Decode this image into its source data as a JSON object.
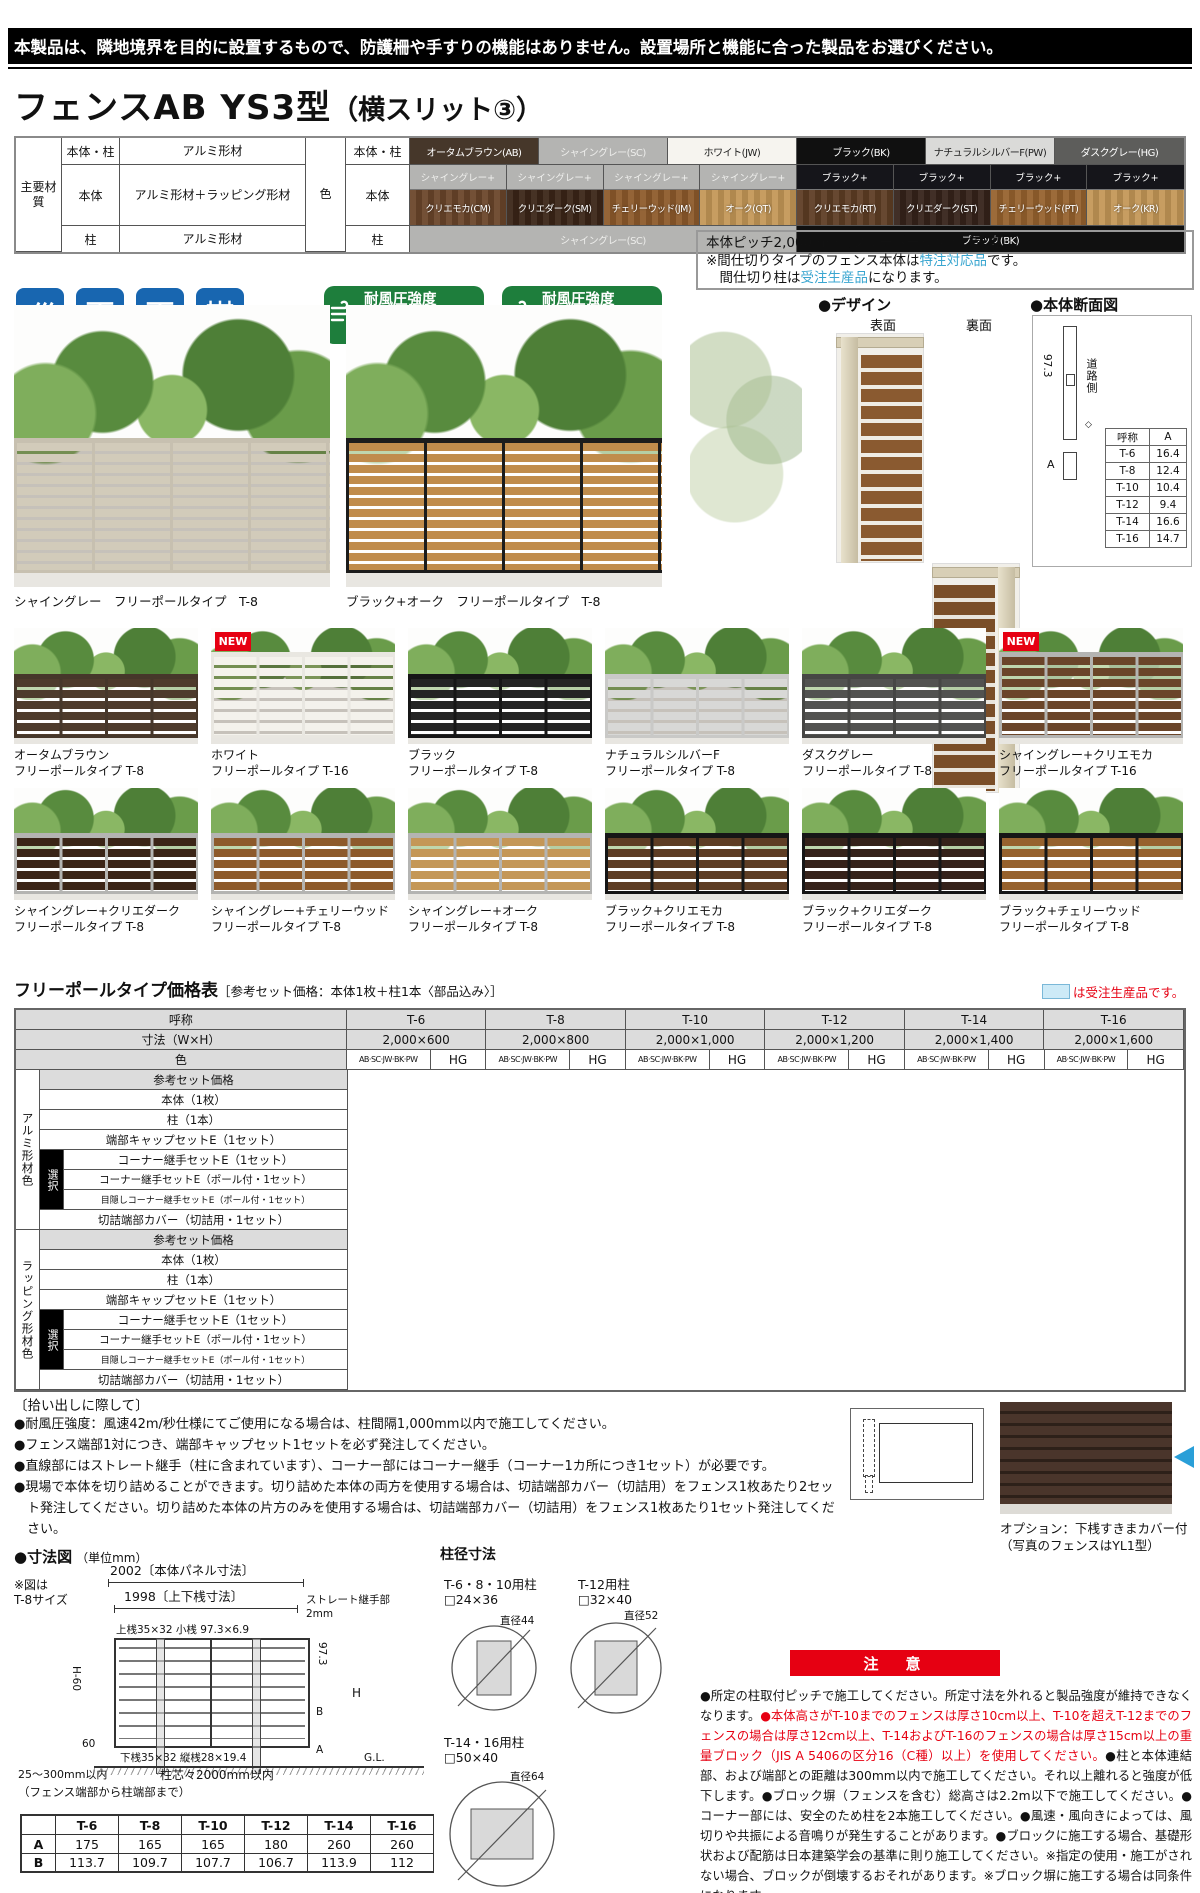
{
  "header": {
    "notice": "本製品は、隣地境界を目的に設置するもので、防護柵や手すりの機能はありません。設置場所と機能に合った製品をお選びください。",
    "title_main": "フェンスAB YS3型",
    "title_sub": "（横スリット③）"
  },
  "spec": {
    "material_group_label": "主要材質",
    "material_rows": [
      {
        "label": "本体・柱",
        "value": "アルミ形材"
      },
      {
        "label": "本体",
        "value": "アルミ形材＋ラッピング形材"
      },
      {
        "label": "柱",
        "value": "アルミ形材"
      }
    ],
    "color_group_label": "色",
    "color_row_labels": [
      "本体・柱",
      "本体",
      "柱"
    ],
    "single_colors": [
      {
        "label": "オータムブラウン(AB)",
        "bg": "#46372a",
        "fg": "#ffffff"
      },
      {
        "label": "シャイングレー(SC)",
        "bg": "#b4b4b2",
        "fg": "#ededeb"
      },
      {
        "label": "ホワイト(JW)",
        "bg": "#f6f4ef",
        "fg": "#222222"
      },
      {
        "label": "ブラック(BK)",
        "bg": "#101010",
        "fg": "#ffffff"
      },
      {
        "label": "ナチュラルシルバーF(PW)",
        "bg": "#dadad8",
        "fg": "#222222"
      },
      {
        "label": "ダスクグレー(HG)",
        "bg": "#5d5d5b",
        "fg": "#ffffff"
      }
    ],
    "combo_colors": [
      {
        "top": "シャイングレー+",
        "top_bg": "#b4b4b2",
        "top_fg": "#f0f0ee",
        "bottom": "クリエモカ(CM)",
        "bottom_bg": "#6a452a"
      },
      {
        "top": "シャイングレー+",
        "top_bg": "#b4b4b2",
        "top_fg": "#f0f0ee",
        "bottom": "クリエダーク(SM)",
        "bottom_bg": "#3b2517"
      },
      {
        "top": "シャイングレー+",
        "top_bg": "#b4b4b2",
        "top_fg": "#f0f0ee",
        "bottom": "チェリーウッド(JM)",
        "bottom_bg": "#8d5a2b"
      },
      {
        "top": "シャイングレー+",
        "top_bg": "#b4b4b2",
        "top_fg": "#f0f0ee",
        "bottom": "オーク(QT)",
        "bottom_bg": "#c49757"
      },
      {
        "top": "ブラック+",
        "top_bg": "#15151a",
        "top_fg": "#ffffff",
        "bottom": "クリエモカ(RT)",
        "bottom_bg": "#5e3d24"
      },
      {
        "top": "ブラック+",
        "top_bg": "#15151a",
        "top_fg": "#ffffff",
        "bottom": "クリエダーク(ST)",
        "bottom_bg": "#35221a"
      },
      {
        "top": "ブラック+",
        "top_bg": "#15151a",
        "top_fg": "#ffffff",
        "bottom": "チェリーウッド(PT)",
        "bottom_bg": "#96622e"
      },
      {
        "top": "ブラック+",
        "top_bg": "#15151a",
        "top_fg": "#ffffff",
        "bottom": "オーク(KR)",
        "bottom_bg": "#c49757"
      }
    ],
    "post_colors": [
      {
        "label": "シャイングレー(SC)",
        "bg": "#b4b4b2",
        "fg": "#ededeb"
      },
      {
        "label": "ブラック(BK)",
        "bg": "#101010",
        "fg": "#ffffff"
      }
    ]
  },
  "features": {
    "icons": [
      {
        "label": "片面模様"
      },
      {
        "label": "フリーポール（自在柱）"
      },
      {
        "label": "間仕切り※（間柱）"
      },
      {
        "label": "多段取付可能"
      }
    ],
    "wind_badges": [
      {
        "title": "耐風圧強度",
        "prefix": "風速",
        "value": "34",
        "unit": "m/秒",
        "suffix": "相当",
        "caption": "柱ピッチ2m以下"
      },
      {
        "title": "耐風圧強度",
        "prefix": "風速",
        "value": "42",
        "unit": "m/秒",
        "suffix": "相当",
        "caption": "柱ピッチ1m以下"
      }
    ],
    "info_box": {
      "line1": "本体ピッチ2,000mm（フリーポールタイプ専用）",
      "line2_pre": "※間仕切りタイプのフェンス本体は",
      "line2_em": "特注対応品",
      "line2_post": "です。",
      "line3_pre": "　間仕切り柱は",
      "line3_em": "受注生産品",
      "line3_post": "になります。"
    }
  },
  "design": {
    "heading": "●デザイン",
    "front_label": "表面",
    "back_label": "裏面"
  },
  "cross_section": {
    "heading": "●本体断面図",
    "dim": "97.3",
    "road_label": "道路側",
    "a_label": "A",
    "table": {
      "headers": [
        "呼称",
        "A"
      ],
      "rows": [
        [
          "T-6",
          "16.4"
        ],
        [
          "T-8",
          "12.4"
        ],
        [
          "T-10",
          "10.4"
        ],
        [
          "T-12",
          "9.4"
        ],
        [
          "T-14",
          "16.6"
        ],
        [
          "T-16",
          "14.7"
        ]
      ]
    }
  },
  "photos": {
    "new_badge": "NEW",
    "row1": [
      {
        "caption": "シャイングレー　フリーポールタイプ　T-8",
        "frame": "#c7c0b0",
        "slat": "#d2cbba",
        "tall": false,
        "new": false
      },
      {
        "caption": "ブラック+オーク　フリーポールタイプ　T-8",
        "frame": "#1c1c1c",
        "slat": "#c08c4c",
        "tall": false,
        "new": false
      }
    ],
    "row2": [
      {
        "name": "オータムブラウン",
        "type": "フリーポールタイプ T-8",
        "frame": "#46372a",
        "slat": "#4e3b2c",
        "new": false,
        "tall": false
      },
      {
        "name": "ホワイト",
        "type": "フリーポールタイプ T-16",
        "frame": "#e9e7e1",
        "slat": "#f4f2ec",
        "new": true,
        "tall": true
      },
      {
        "name": "ブラック",
        "type": "フリーポールタイプ T-8",
        "frame": "#161616",
        "slat": "#242424",
        "new": false,
        "tall": false
      },
      {
        "name": "ナチュラルシルバーF",
        "type": "フリーポールタイプ T-8",
        "frame": "#c9c9c7",
        "slat": "#d8d8d6",
        "new": false,
        "tall": false
      },
      {
        "name": "ダスクグレー",
        "type": "フリーポールタイプ T-8",
        "frame": "#464644",
        "slat": "#525250",
        "new": false,
        "tall": false
      },
      {
        "name": "シャイングレー+クリエモカ",
        "type": "フリーポールタイプ T-16",
        "frame": "#b4b4b2",
        "slat": "#6a452a",
        "new": true,
        "tall": true
      }
    ],
    "row3": [
      {
        "name": "シャイングレー+クリエダーク",
        "type": "フリーポールタイプ T-8",
        "frame": "#b4b4b2",
        "slat": "#3b2517",
        "new": false,
        "tall": false
      },
      {
        "name": "シャイングレー+チェリーウッド",
        "type": "フリーポールタイプ T-8",
        "frame": "#b4b4b2",
        "slat": "#8d5a2b",
        "new": false,
        "tall": false
      },
      {
        "name": "シャイングレー+オーク",
        "type": "フリーポールタイプ T-8",
        "frame": "#b4b4b2",
        "slat": "#c49757",
        "new": false,
        "tall": false
      },
      {
        "name": "ブラック+クリエモカ",
        "type": "フリーポールタイプ T-8",
        "frame": "#161616",
        "slat": "#5e3d24",
        "new": false,
        "tall": false
      },
      {
        "name": "ブラック+クリエダーク",
        "type": "フリーポールタイプ T-8",
        "frame": "#161616",
        "slat": "#35221a",
        "new": false,
        "tall": false
      },
      {
        "name": "ブラック+チェリーウッド",
        "type": "フリーポールタイプ T-8",
        "frame": "#161616",
        "slat": "#96622e",
        "new": false,
        "tall": false
      }
    ]
  },
  "price_table": {
    "title": "フリーポールタイプ価格表",
    "subtitle": "［参考セット価格：本体1枚＋柱1本〈部品込み〉］",
    "legend": "は受注生産品です。",
    "col_header_label": "呼称",
    "size_header_label": "寸法（W×H）",
    "color_header_label": "色",
    "columns": [
      {
        "name": "T-6",
        "size": "2,000×600"
      },
      {
        "name": "T-8",
        "size": "2,000×800"
      },
      {
        "name": "T-10",
        "size": "2,000×1,000"
      },
      {
        "name": "T-12",
        "size": "2,000×1,200"
      },
      {
        "name": "T-14",
        "size": "2,000×1,400"
      },
      {
        "name": "T-16",
        "size": "2,000×1,600"
      }
    ],
    "color_sub_a": "AB·SC·JW·BK·PW",
    "color_sub_b": "HG",
    "group1_label": "アルミ形材色",
    "group2_label": "ラッピング形材色",
    "select_label": "選択",
    "row_labels": [
      "参考セット価格",
      "本体（1枚）",
      "柱（1本）",
      "端部キャップセットE（1セット）",
      "コーナー継手セットE（1セット）",
      "コーナー継手セットE（ポール付・1セット）",
      "目隠しコーナー継手セットE（ポール付・1セット）",
      "切詰端部カバー（切詰用・1セット）"
    ]
  },
  "notes": {
    "heading": "〔拾い出しに際して〕",
    "bullets": [
      "●耐風圧強度：風速42m/秒仕様にてご使用になる場合は、柱間隔1,000mm以内で施工してください。",
      "●フェンス端部1対につき、端部キャップセット1セットを必ず発注してください。",
      "●直線部にはストレート継手（柱に含まれています）、コーナー部にはコーナー継手（コーナー1カ所につき1セット）が必要です。",
      "●現場で本体を切り詰めることができます。切り詰めた本体の両方を使用する場合は、切詰端部カバー（切詰用）をフェンス1枚あたり2セット発注してください。切り詰めた本体の片方のみを使用する場合は、切詰端部カバー（切詰用）をフェンス1枚あたり1セット発注してください。"
    ],
    "option_caption1": "オプション：下桟すきまカバー付",
    "option_caption2": "（写真のフェンスはYL1型）"
  },
  "dimension": {
    "heading": "●寸法図",
    "unit": "（単位mm）",
    "note1": "※図は",
    "note2": "T-8サイズ",
    "dim_panel": "2002〔本体パネル寸法〕",
    "dim_rail": "1998〔上下桟寸法〕",
    "joint_label1": "ストレート継手部",
    "joint_label2": "2mm",
    "top_rail": "上桟35×32 小桟 97.3×6.9",
    "bottom_rail": "下桟35×32 縦桟28×19.4",
    "h60": "H-60",
    "v60": "60",
    "d973": "97.3",
    "b": "B",
    "h": "H",
    "a": "A",
    "gl": "G.L.",
    "edge": "25～300mm以内",
    "edge2": "（フェンス端部から柱端部まで）",
    "pitch": "柱芯々2000mm以内"
  },
  "post_sizes": {
    "heading": "柱径寸法",
    "items": [
      {
        "label": "T-6・8・10用柱",
        "size": "□24×36",
        "dia": "直径44"
      },
      {
        "label": "T-12用柱",
        "size": "□32×40",
        "dia": "直径52"
      },
      {
        "label": "T-14・16用柱",
        "size": "□50×40",
        "dia": "直径64"
      }
    ]
  },
  "ab_table": {
    "headers": [
      "",
      "T-6",
      "T-8",
      "T-10",
      "T-12",
      "T-14",
      "T-16"
    ],
    "rows": [
      {
        "label": "A",
        "values": [
          "175",
          "165",
          "165",
          "180",
          "260",
          "260"
        ]
      },
      {
        "label": "B",
        "values": [
          "113.7",
          "109.7",
          "107.7",
          "106.7",
          "113.9",
          "112"
        ]
      }
    ]
  },
  "caution": {
    "banner": "注　意",
    "segments": [
      {
        "color": "black",
        "text": "●所定の柱取付ピッチで施工してください。所定寸法を外れると製品強度が維持できなくなります。"
      },
      {
        "color": "red",
        "text": "●本体高さがT-10までのフェンスは厚さ10cm以上、T-10を超えT-12までのフェンスの場合は厚さ12cm以上、T-14およびT-16のフェンスの場合は厚さ15cm以上の重量ブロック（JIS A 5406の区分16（C種）以上）を使用してください。"
      },
      {
        "color": "black",
        "text": "●柱と本体連結部、および端部との距離は300mm以内で施工してください。それ以上離れると強度が低下します。●ブロック塀（フェンスを含む）総高さは2.2m以下で施工してください。●コーナー部には、安全のため柱を2本施工してください。●風速・風向きによっては、風切りや共振による音鳴りが発生することがあります。●ブロックに施工する場合、基礎形状および配筋は日本建築学会の基準に則り施工してください。※指定の使用・施工がされない場合、ブロックが倒壊するおそれがあります。※ブロック塀に施工する場合は同条件になります。"
      }
    ]
  },
  "colors": {
    "accent_red": "#e60012",
    "badge_green": "#1e7e3c",
    "icon_blue": "#1866b0",
    "info_blue": "#3aa6d0",
    "legend_fill": "#cdeaf7"
  }
}
